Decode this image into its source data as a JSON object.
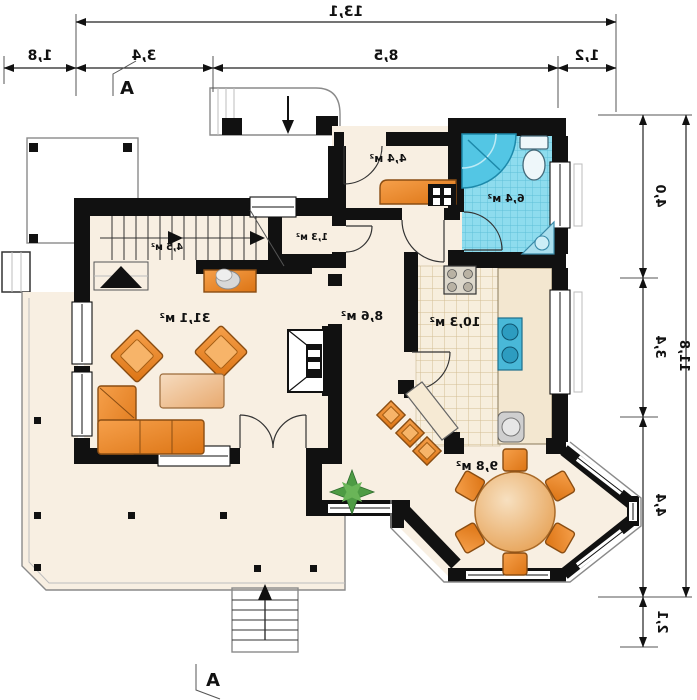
{
  "colors": {
    "wall": "#111111",
    "floor_cream": "#f8efe2",
    "furniture_orange": "#e8892e",
    "bathroom_blue": "#8edcee",
    "kitchen_tile": "#f7eedd",
    "plant_green": "#4e9b44",
    "dimension_line": "#222222"
  },
  "dimensions": {
    "top": {
      "total": "13,1",
      "segments": [
        "1,8",
        "3,4",
        "8,5",
        "1,2"
      ]
    },
    "right": {
      "total": "11,8",
      "segments": [
        "4,0",
        "3,4",
        "4,4",
        "2,1"
      ]
    }
  },
  "section_marker": {
    "label": "A"
  },
  "rooms": [
    {
      "name": "stairs",
      "area_label": "4,5 м²"
    },
    {
      "name": "wc",
      "area_label": "1,3 м²"
    },
    {
      "name": "hall",
      "area_label": "4,4 м²"
    },
    {
      "name": "bathroom",
      "area_label": "6,4 м²"
    },
    {
      "name": "corridor",
      "area_label": "8,6 м²"
    },
    {
      "name": "kitchen",
      "area_label": "10,3 м²"
    },
    {
      "name": "living-room",
      "area_label": "31,1 м²"
    },
    {
      "name": "dining-room",
      "area_label": "9,8 м²"
    }
  ]
}
